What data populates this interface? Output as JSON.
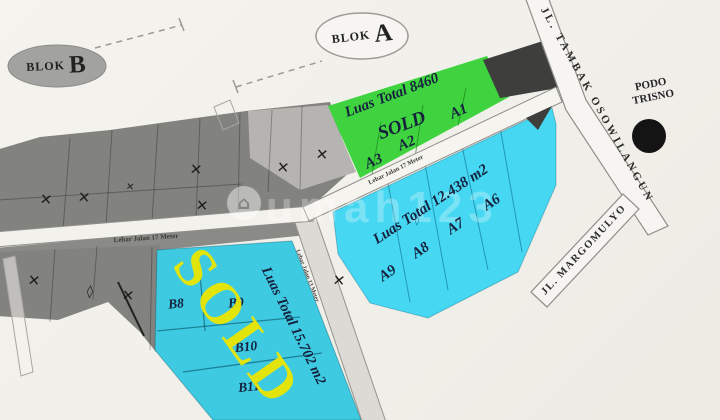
{
  "map": {
    "blok_a": {
      "prefix": "BLOK",
      "letter": "A"
    },
    "blok_b": {
      "prefix": "BLOK",
      "letter": "B"
    },
    "roads": {
      "tambak_osowilangun": "JL. TAMBAK OSOWILANGUN",
      "margomulyo": "JL. MARGOMULYO",
      "lebar_jalan_17_upper": "Lebar Jalan 17 Meter",
      "lebar_jalan_17_lower": "Lebar Jalan 17 Meter",
      "lebar_jalan_13": "Lebar Jalan 13 Meter"
    },
    "landmark": {
      "line1": "PODO",
      "line2": "TRISNO"
    },
    "green_block": {
      "area": "Luas Total 8460",
      "status": "SOLD",
      "plots": [
        "A3",
        "A2",
        "A1"
      ]
    },
    "cyan_block_a": {
      "area": "Luas Total 12.438 m2",
      "plots": [
        "A9",
        "A8",
        "A7",
        "A6"
      ]
    },
    "cyan_block_b": {
      "area": "Luas Total 15.702 m2",
      "status_overlay": "SOLD",
      "plots": [
        "B8",
        "B9",
        "B10",
        "B11"
      ]
    },
    "watermark": {
      "logo": "⌂",
      "text": "umah123"
    },
    "icons": {
      "cross": "✕",
      "diamond": "◊"
    },
    "colors": {
      "green": "#3fd43f",
      "cyan_a": "#46d7f2",
      "cyan_b": "#3ecbe2",
      "band_dark": "#82827e",
      "sold_yellow": "#ece600"
    }
  }
}
